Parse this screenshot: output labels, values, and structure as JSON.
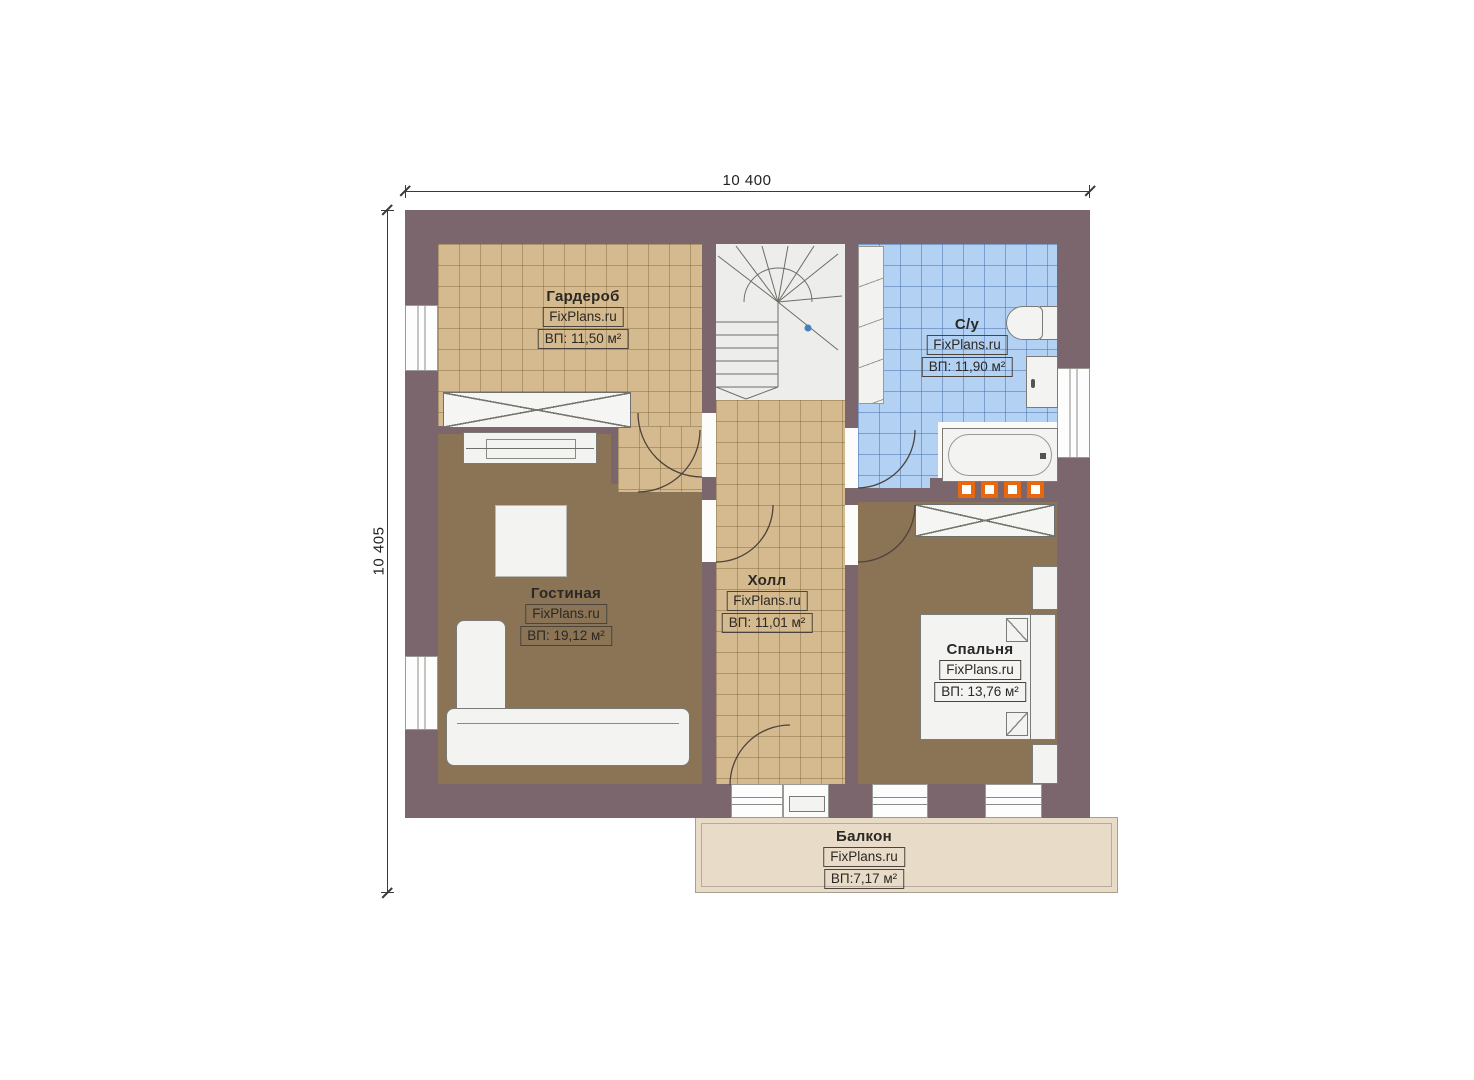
{
  "plan": {
    "dimension_top": "10 400",
    "dimension_left": "10 405"
  },
  "rooms": [
    {
      "key": "wardrobe",
      "name": "Гардероб",
      "brand": "FixPlans.ru",
      "area": "ВП: 11,50 м²"
    },
    {
      "key": "bathroom",
      "name": "С/у",
      "brand": "FixPlans.ru",
      "area": "ВП: 11,90 м²"
    },
    {
      "key": "living",
      "name": "Гостиная",
      "brand": "FixPlans.ru",
      "area": "ВП: 19,12 м²"
    },
    {
      "key": "hall",
      "name": "Холл",
      "brand": "FixPlans.ru",
      "area": "ВП: 11,01 м²"
    },
    {
      "key": "bedroom",
      "name": "Спальня",
      "brand": "FixPlans.ru",
      "area": "ВП: 13,76 м²"
    },
    {
      "key": "balcony",
      "name": "Балкон",
      "brand": "FixPlans.ru",
      "area": "ВП:7,17 м²"
    }
  ],
  "colors": {
    "wall": "#7c666d",
    "tile_tan": "#d4ba8e",
    "tile_blue": "#b3d1f2",
    "floor_brown": "#8b7455",
    "balcony": "#e8dcc8",
    "radiator_orange": "#e8680f",
    "stair_marker_blue": "#4a7ec0"
  }
}
